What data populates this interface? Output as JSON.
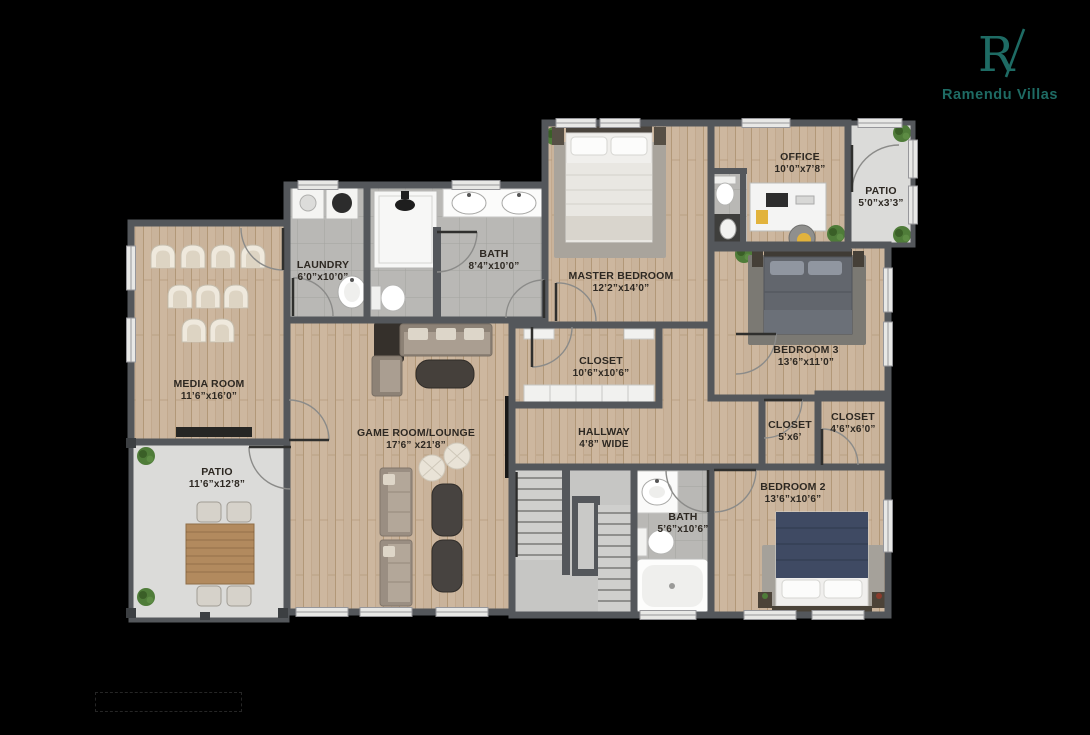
{
  "canvas": {
    "width": 1090,
    "height": 735,
    "background": "#000000"
  },
  "brand": {
    "monogram": "RV",
    "monogram_letter": "R",
    "name": "Ramendu Villas",
    "color": "#1E6B64"
  },
  "palette": {
    "wall": "#54575B",
    "wood_floor": "#C9B39B",
    "tile_floor": "#B9B8B5",
    "concrete_floor": "#DBDBD9",
    "stairs": "#C6C6C4",
    "label_text": "#2D2822",
    "background": "#000000"
  },
  "rooms": {
    "media_room": {
      "name": "MEDIA ROOM",
      "dims": "11’6”x16’0”",
      "floor": "wood"
    },
    "patio_left": {
      "name": "PATIO",
      "dims": "11’6”x12’8”",
      "floor": "concrete"
    },
    "laundry": {
      "name": "LAUNDRY",
      "dims": "6’0”x10’0”",
      "floor": "tile"
    },
    "bath_top": {
      "name": "BATH",
      "dims": "8’4”x10’0”",
      "floor": "tile"
    },
    "game_room": {
      "name": "GAME ROOM/LOUNGE",
      "dims": "17’6” x21’8”",
      "floor": "wood"
    },
    "master_bedroom": {
      "name": "MASTER BEDROOM",
      "dims": "12’2”x14’0”",
      "floor": "wood"
    },
    "closet_hall": {
      "name": "CLOSET",
      "dims": "10’6”x10’6”",
      "floor": "wood"
    },
    "hallway": {
      "name": "HALLWAY",
      "dims": "4’8” WIDE",
      "floor": "wood"
    },
    "office": {
      "name": "OFFICE",
      "dims": "10’0”x7’8”",
      "floor": "wood"
    },
    "patio_top_right": {
      "name": "PATIO",
      "dims": "5’0”x3’3”",
      "floor": "concrete"
    },
    "bedroom_3": {
      "name": "BEDROOM 3",
      "dims": "13’6”x11’0”",
      "floor": "wood"
    },
    "closet_small": {
      "name": "CLOSET",
      "dims": "5’x6’",
      "floor": "wood"
    },
    "closet_bedroom2": {
      "name": "CLOSET",
      "dims": "4’6”x6’0”",
      "floor": "wood"
    },
    "bedroom_2": {
      "name": "BEDROOM 2",
      "dims": "13’6”x10’6”",
      "floor": "wood"
    },
    "bath_bottom": {
      "name": "BATH",
      "dims": "5’6”x10’6”",
      "floor": "tile"
    }
  },
  "furniture_icons": [
    "theater-seats",
    "media-console",
    "patio-dining-set",
    "plant",
    "washer-dryer",
    "pedestal-sink",
    "shower",
    "double-vanity-sinks",
    "toilet",
    "sectional-sofa",
    "coffee-table",
    "pouf",
    "sofa",
    "lounge-table",
    "wall-tv",
    "double-bed",
    "nightstand",
    "area-rug",
    "desk",
    "office-chair",
    "wardrobe",
    "staircase",
    "vanity-sink",
    "bathtub"
  ]
}
